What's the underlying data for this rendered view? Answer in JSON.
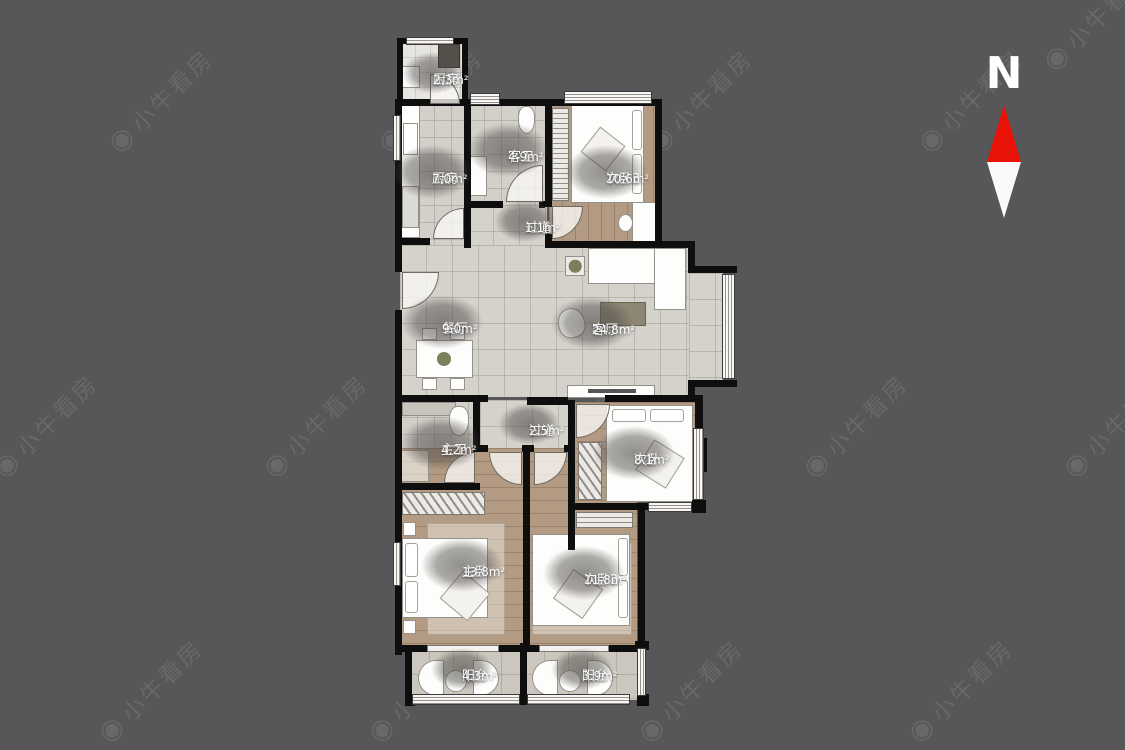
{
  "watermark": {
    "brand": "小牛看房",
    "icon": "◉"
  },
  "compass": {
    "label": "N"
  },
  "rooms": [
    {
      "id": "kitchen-small",
      "name": "厨房",
      "area": "2.3m²"
    },
    {
      "id": "kitchen",
      "name": "厨房",
      "area": "7.0m²"
    },
    {
      "id": "guest-bath",
      "name": "客卫",
      "area": "4.9m²"
    },
    {
      "id": "bedroom3",
      "name": "次卧3",
      "area": "10.6m²"
    },
    {
      "id": "hallway1",
      "name": "过道",
      "area": "1.1m²"
    },
    {
      "id": "dining",
      "name": "餐厅",
      "area": "9.0m²"
    },
    {
      "id": "living",
      "name": "客厅",
      "area": "24.8m²"
    },
    {
      "id": "hallway2",
      "name": "过道",
      "area": "2.5m²"
    },
    {
      "id": "master-bath",
      "name": "主卫",
      "area": "4.2m²"
    },
    {
      "id": "bedroom-side",
      "name": "次卧",
      "area": "8.1m²"
    },
    {
      "id": "master-bedroom",
      "name": "主卧",
      "area": "13.8m²"
    },
    {
      "id": "bedroom2",
      "name": "次卧2",
      "area": "11.8m²"
    },
    {
      "id": "balcony-left",
      "name": "阳台",
      "area": "4.3m²"
    },
    {
      "id": "balcony-right",
      "name": "阳台",
      "area": "3.9m²"
    }
  ],
  "colors": {
    "background": "#57575a",
    "wall": "#0e0e0e",
    "compass_red": "#ea1308",
    "floor_tile": "#d5d2cc",
    "floor_wood": "#b29a83"
  }
}
